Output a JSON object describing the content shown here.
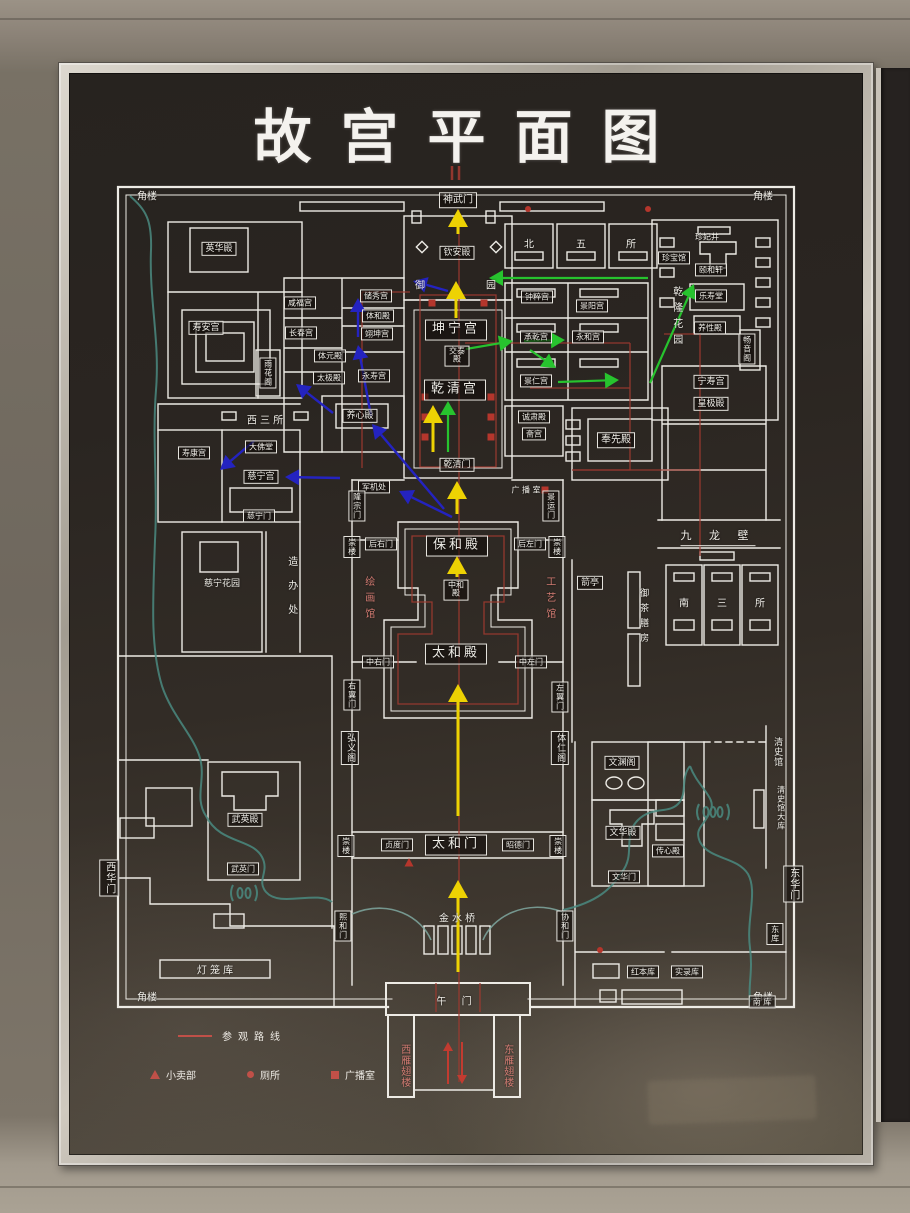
{
  "title": "故宫平面图",
  "legend": {
    "route_label": "参观路线",
    "kiosk_label": "小卖部",
    "toilet_label": "厕所",
    "broadcast_label": "广播室"
  },
  "map": {
    "colors": {
      "wall": "#edebe5",
      "river": "#4a8a80",
      "route": "#9e3a30",
      "marker": "#b5362c",
      "yellow": "#edd203",
      "green": "#27c32e",
      "blue": "#2423c0",
      "red": "#c23b30"
    },
    "labels": [
      {
        "name": "corner-tower-nw",
        "text": "角楼",
        "x": 147,
        "y": 197,
        "cls": "plain"
      },
      {
        "name": "corner-tower-ne",
        "text": "角楼",
        "x": 763,
        "y": 197,
        "cls": "plain"
      },
      {
        "name": "corner-tower-sw",
        "text": "角楼",
        "x": 147,
        "y": 998,
        "cls": "plain"
      },
      {
        "name": "corner-tower-se",
        "text": "角楼",
        "x": 763,
        "y": 998,
        "cls": "plain"
      },
      {
        "name": "label-shenwumen",
        "text": "神武门",
        "x": 458,
        "y": 200,
        "cls": "boxed"
      },
      {
        "name": "label-yinghuadian",
        "text": "英华殿",
        "x": 219,
        "y": 249,
        "cls": "boxed sm"
      },
      {
        "name": "label-shouangong",
        "text": "寿安宫",
        "x": 206,
        "y": 328,
        "cls": "boxed sm"
      },
      {
        "name": "label-yuhuage",
        "text": "雨花阁",
        "x": 268,
        "y": 373,
        "cls": "boxed v xs"
      },
      {
        "name": "label-xianfugong",
        "text": "咸福宫",
        "x": 300,
        "y": 303,
        "cls": "boxed xs"
      },
      {
        "name": "label-changchungong",
        "text": "长春宫",
        "x": 301,
        "y": 333,
        "cls": "boxed xs"
      },
      {
        "name": "label-tiyuandian",
        "text": "体元殿",
        "x": 330,
        "y": 356,
        "cls": "boxed xs"
      },
      {
        "name": "label-taijidian",
        "text": "太极殿",
        "x": 329,
        "y": 378,
        "cls": "boxed xs"
      },
      {
        "name": "label-chuxiugong",
        "text": "储秀宫",
        "x": 376,
        "y": 296,
        "cls": "boxed xs"
      },
      {
        "name": "label-tihedian",
        "text": "体和殿",
        "x": 378,
        "y": 316,
        "cls": "boxed xs"
      },
      {
        "name": "label-yikungong",
        "text": "翊坤宫",
        "x": 377,
        "y": 334,
        "cls": "boxed xs"
      },
      {
        "name": "label-yongshougong",
        "text": "永寿宫",
        "x": 374,
        "y": 376,
        "cls": "boxed xs"
      },
      {
        "name": "label-yangxindian",
        "text": "养心殿",
        "x": 360,
        "y": 416,
        "cls": "boxed sm"
      },
      {
        "name": "label-kunninggong",
        "text": "坤宁宫",
        "x": 456,
        "y": 330,
        "cls": "boxed big"
      },
      {
        "name": "label-jiaotaidian",
        "text": "交泰殿",
        "x": 457,
        "y": 356,
        "cls": "boxed xs narrow"
      },
      {
        "name": "label-qianqinggong",
        "text": "乾清宫",
        "x": 455,
        "y": 390,
        "cls": "boxed big"
      },
      {
        "name": "label-qianqingmen",
        "text": "乾清门",
        "x": 457,
        "y": 465,
        "cls": "boxed sm"
      },
      {
        "name": "label-junjichu",
        "text": "军机处",
        "x": 374,
        "y": 487,
        "cls": "boxed xs"
      },
      {
        "name": "label-longzongmen",
        "text": "隆宗门",
        "x": 357,
        "y": 506,
        "cls": "boxed v xs"
      },
      {
        "name": "label-jingyunmen",
        "text": "景运门",
        "x": 551,
        "y": 506,
        "cls": "boxed v xs"
      },
      {
        "name": "label-broadcast-room",
        "text": "广 播 室",
        "x": 526,
        "y": 490,
        "cls": "plain xs"
      },
      {
        "name": "label-qinandian",
        "text": "钦安殿",
        "x": 457,
        "y": 253,
        "cls": "boxed sm"
      },
      {
        "name": "label-yu",
        "text": "御",
        "x": 420,
        "y": 286,
        "cls": "plain"
      },
      {
        "name": "label-yuan",
        "text": "园",
        "x": 491,
        "y": 286,
        "cls": "plain"
      },
      {
        "name": "label-bei",
        "text": "北",
        "x": 529,
        "y": 245,
        "cls": "plain"
      },
      {
        "name": "label-wu",
        "text": "五",
        "x": 581,
        "y": 245,
        "cls": "plain"
      },
      {
        "name": "label-suo",
        "text": "所",
        "x": 631,
        "y": 245,
        "cls": "plain"
      },
      {
        "name": "label-zhongcuigong",
        "text": "钟粹宫",
        "x": 537,
        "y": 297,
        "cls": "boxed xs"
      },
      {
        "name": "label-jingyanggong",
        "text": "景阳宫",
        "x": 592,
        "y": 306,
        "cls": "boxed xs"
      },
      {
        "name": "label-chengqiangong",
        "text": "承乾宫",
        "x": 536,
        "y": 337,
        "cls": "boxed xs"
      },
      {
        "name": "label-yonghegong",
        "text": "永和宫",
        "x": 588,
        "y": 337,
        "cls": "boxed xs"
      },
      {
        "name": "label-jingrengong",
        "text": "景仁宫",
        "x": 536,
        "y": 381,
        "cls": "boxed xs"
      },
      {
        "name": "label-chengsudian",
        "text": "诚肃殿",
        "x": 534,
        "y": 417,
        "cls": "boxed xs"
      },
      {
        "name": "label-zhaigong",
        "text": "斋宫",
        "x": 534,
        "y": 434,
        "cls": "boxed xs"
      },
      {
        "name": "label-fengxiandian",
        "text": "奉先殿",
        "x": 616,
        "y": 440,
        "cls": "boxed"
      },
      {
        "name": "label-zhenfeijing",
        "text": "珍妃井",
        "x": 707,
        "y": 237,
        "cls": "plain xs"
      },
      {
        "name": "label-zhenbaoguan",
        "text": "珍宝馆",
        "x": 674,
        "y": 258,
        "cls": "boxed xs"
      },
      {
        "name": "label-yihexuan",
        "text": "颐和轩",
        "x": 711,
        "y": 270,
        "cls": "boxed xs"
      },
      {
        "name": "label-leshoutang",
        "text": "乐寿堂",
        "x": 711,
        "y": 296,
        "cls": "boxed xs"
      },
      {
        "name": "label-yangxingdian",
        "text": "养性殿",
        "x": 710,
        "y": 328,
        "cls": "boxed xs"
      },
      {
        "name": "label-changyinge",
        "text": "畅音阁",
        "x": 747,
        "y": 349,
        "cls": "boxed v xs"
      },
      {
        "name": "label-qianlong-garden",
        "text": "乾隆花园",
        "x": 676,
        "y": 318,
        "cls": "plain v sp1"
      },
      {
        "name": "label-ningshougong",
        "text": "宁寿宫",
        "x": 711,
        "y": 382,
        "cls": "boxed sm"
      },
      {
        "name": "label-huangjidian",
        "text": "皇极殿",
        "x": 711,
        "y": 404,
        "cls": "boxed sm"
      },
      {
        "name": "label-jiulongbi",
        "text": "九 龙 壁",
        "x": 718,
        "y": 538,
        "cls": "plain und"
      },
      {
        "name": "label-jianting",
        "text": "箭亭",
        "x": 590,
        "y": 583,
        "cls": "boxed sm"
      },
      {
        "name": "label-yuchashanfang",
        "text": "御茶膳房",
        "x": 643,
        "y": 618,
        "cls": "plain v sm sp1"
      },
      {
        "name": "label-nan",
        "text": "南",
        "x": 684,
        "y": 604,
        "cls": "plain"
      },
      {
        "name": "label-san",
        "text": "三",
        "x": 722,
        "y": 604,
        "cls": "plain"
      },
      {
        "name": "label-suo-2",
        "text": "所",
        "x": 760,
        "y": 604,
        "cls": "plain"
      },
      {
        "name": "label-baohedian",
        "text": "保和殿",
        "x": 457,
        "y": 546,
        "cls": "boxed big"
      },
      {
        "name": "label-houyoumen",
        "text": "后右门",
        "x": 381,
        "y": 544,
        "cls": "boxed xs"
      },
      {
        "name": "label-houzuomen",
        "text": "后左门",
        "x": 530,
        "y": 544,
        "cls": "boxed xs"
      },
      {
        "name": "label-chonglou-nw",
        "text": "崇楼",
        "x": 352,
        "y": 547,
        "cls": "boxed v xs"
      },
      {
        "name": "label-chonglou-ne",
        "text": "崇楼",
        "x": 557,
        "y": 547,
        "cls": "boxed v xs"
      },
      {
        "name": "label-chonglou-sw",
        "text": "崇楼",
        "x": 346,
        "y": 846,
        "cls": "boxed v xs"
      },
      {
        "name": "label-chonglou-se",
        "text": "崇楼",
        "x": 558,
        "y": 846,
        "cls": "boxed v xs"
      },
      {
        "name": "label-zhonghedian",
        "text": "中和殿",
        "x": 456,
        "y": 590,
        "cls": "boxed xs narrow"
      },
      {
        "name": "label-taihedian",
        "text": "太和殿",
        "x": 456,
        "y": 654,
        "cls": "boxed big"
      },
      {
        "name": "label-zhongyoumen",
        "text": "中右门",
        "x": 378,
        "y": 662,
        "cls": "boxed xs"
      },
      {
        "name": "label-zhongzuomen",
        "text": "中左门",
        "x": 531,
        "y": 662,
        "cls": "boxed xs"
      },
      {
        "name": "label-youyimen",
        "text": "右翼门",
        "x": 352,
        "y": 695,
        "cls": "boxed v xs"
      },
      {
        "name": "label-zuoyimen",
        "text": "左翼门",
        "x": 560,
        "y": 697,
        "cls": "boxed v xs"
      },
      {
        "name": "label-hongyige",
        "text": "弘义阁",
        "x": 350,
        "y": 748,
        "cls": "boxed v sm"
      },
      {
        "name": "label-tirenge",
        "text": "体仁阁",
        "x": 560,
        "y": 748,
        "cls": "boxed v sm"
      },
      {
        "name": "label-painting-gallery",
        "text": "绘画馆",
        "x": 368,
        "y": 600,
        "cls": "red v sp1"
      },
      {
        "name": "label-craft-gallery",
        "text": "工艺馆",
        "x": 549,
        "y": 600,
        "cls": "red v sp1"
      },
      {
        "name": "label-taihemen",
        "text": "太和门",
        "x": 456,
        "y": 845,
        "cls": "boxed big"
      },
      {
        "name": "label-zhendumen",
        "text": "贞度门",
        "x": 397,
        "y": 845,
        "cls": "boxed xs"
      },
      {
        "name": "label-zhaodemen",
        "text": "昭德门",
        "x": 518,
        "y": 845,
        "cls": "boxed xs"
      },
      {
        "name": "label-xihemen-gate",
        "text": "熙和门",
        "x": 343,
        "y": 926,
        "cls": "boxed v xs"
      },
      {
        "name": "label-xiehemen",
        "text": "协和门",
        "x": 565,
        "y": 926,
        "cls": "boxed v xs"
      },
      {
        "name": "label-jinshuiqiao",
        "text": "金 水 桥",
        "x": 457,
        "y": 919,
        "cls": "plain"
      },
      {
        "name": "label-wumen",
        "text": "午 门",
        "x": 457,
        "y": 1002,
        "cls": "plain sp1"
      },
      {
        "name": "label-west-wing",
        "text": "西雁翅楼",
        "x": 404,
        "y": 1066,
        "cls": "red v"
      },
      {
        "name": "label-east-wing",
        "text": "东雁翅楼",
        "x": 507,
        "y": 1066,
        "cls": "red v"
      },
      {
        "name": "label-dafotang",
        "text": "大佛堂",
        "x": 261,
        "y": 447,
        "cls": "boxed xs"
      },
      {
        "name": "label-cininggong",
        "text": "慈宁宫",
        "x": 261,
        "y": 477,
        "cls": "boxed sm"
      },
      {
        "name": "label-ciningmen",
        "text": "慈宁门",
        "x": 259,
        "y": 516,
        "cls": "boxed xs"
      },
      {
        "name": "label-shoukanggong",
        "text": "寿康宫",
        "x": 194,
        "y": 453,
        "cls": "boxed xs"
      },
      {
        "name": "label-xisansuo",
        "text": "西 三 所",
        "x": 265,
        "y": 421,
        "cls": "plain"
      },
      {
        "name": "label-cining-garden",
        "text": "慈宁花园",
        "x": 222,
        "y": 584,
        "cls": "plain sm"
      },
      {
        "name": "label-zaobanchu",
        "text": "造办处",
        "x": 291,
        "y": 592,
        "cls": "plain v sp2"
      },
      {
        "name": "label-wuyingdian",
        "text": "武英殿",
        "x": 245,
        "y": 820,
        "cls": "boxed sm"
      },
      {
        "name": "label-wuyingmen",
        "text": "武英门",
        "x": 243,
        "y": 869,
        "cls": "boxed xs"
      },
      {
        "name": "label-xihuamen",
        "text": "西华门",
        "x": 109,
        "y": 878,
        "cls": "boxed v"
      },
      {
        "name": "label-donghuamen",
        "text": "东华门",
        "x": 793,
        "y": 884,
        "cls": "boxed v"
      },
      {
        "name": "label-wenyuange",
        "text": "文渊阁",
        "x": 622,
        "y": 763,
        "cls": "boxed sm"
      },
      {
        "name": "label-wenhuadian",
        "text": "文华殿",
        "x": 623,
        "y": 833,
        "cls": "boxed sm"
      },
      {
        "name": "label-chuanxindian",
        "text": "传心殿",
        "x": 668,
        "y": 851,
        "cls": "boxed xs"
      },
      {
        "name": "label-wenhuamen",
        "text": "文华门",
        "x": 624,
        "y": 877,
        "cls": "boxed xs"
      },
      {
        "name": "label-qingshiguan",
        "text": "清史馆",
        "x": 777,
        "y": 752,
        "cls": "plain v sm"
      },
      {
        "name": "label-qingshiguan-daku",
        "text": "清史馆大库",
        "x": 781,
        "y": 808,
        "cls": "plain v xs"
      },
      {
        "name": "label-hongbenku",
        "text": "红本库",
        "x": 643,
        "y": 972,
        "cls": "boxed xs"
      },
      {
        "name": "label-shiluku",
        "text": "实录库",
        "x": 687,
        "y": 972,
        "cls": "boxed xs"
      },
      {
        "name": "label-nanku",
        "text": "南  库",
        "x": 762,
        "y": 1002,
        "cls": "boxed xs"
      },
      {
        "name": "label-dongku",
        "text": "东库",
        "x": 775,
        "y": 934,
        "cls": "boxed v xs"
      },
      {
        "name": "label-denglongku",
        "text": "灯 笼 库",
        "x": 215,
        "y": 971,
        "cls": "plain"
      }
    ],
    "arrows": [
      {
        "color": "yellow",
        "x1": 458,
        "y1": 972,
        "x2": 458,
        "y2": 880
      },
      {
        "color": "yellow",
        "x1": 458,
        "y1": 816,
        "x2": 458,
        "y2": 684
      },
      {
        "color": "yellow",
        "x1": 457,
        "y1": 577,
        "x2": 457,
        "y2": 556
      },
      {
        "color": "yellow",
        "x1": 457,
        "y1": 514,
        "x2": 457,
        "y2": 481
      },
      {
        "color": "yellow",
        "x1": 433,
        "y1": 452,
        "x2": 433,
        "y2": 405
      },
      {
        "color": "yellow",
        "x1": 456,
        "y1": 318,
        "x2": 456,
        "y2": 281
      },
      {
        "color": "yellow",
        "x1": 458,
        "y1": 234,
        "x2": 458,
        "y2": 209
      },
      {
        "color": "green",
        "x1": 448,
        "y1": 452,
        "x2": 448,
        "y2": 401
      },
      {
        "color": "green",
        "x1": 466,
        "y1": 349,
        "x2": 513,
        "y2": 341
      },
      {
        "color": "green",
        "x1": 524,
        "y1": 341,
        "x2": 565,
        "y2": 340
      },
      {
        "color": "green",
        "x1": 530,
        "y1": 350,
        "x2": 556,
        "y2": 368
      },
      {
        "color": "green",
        "x1": 558,
        "y1": 382,
        "x2": 619,
        "y2": 380
      },
      {
        "color": "green",
        "x1": 650,
        "y1": 383,
        "x2": 694,
        "y2": 284
      },
      {
        "color": "green",
        "x1": 648,
        "y1": 278,
        "x2": 489,
        "y2": 278
      },
      {
        "color": "blue",
        "x1": 452,
        "y1": 517,
        "x2": 399,
        "y2": 491
      },
      {
        "color": "blue",
        "x1": 444,
        "y1": 509,
        "x2": 372,
        "y2": 424
      },
      {
        "color": "blue",
        "x1": 371,
        "y1": 416,
        "x2": 358,
        "y2": 345
      },
      {
        "color": "blue",
        "x1": 358,
        "y1": 337,
        "x2": 358,
        "y2": 298
      },
      {
        "color": "blue",
        "x1": 333,
        "y1": 413,
        "x2": 296,
        "y2": 384
      },
      {
        "color": "blue",
        "x1": 448,
        "y1": 291,
        "x2": 413,
        "y2": 281
      },
      {
        "color": "blue",
        "x1": 340,
        "y1": 478,
        "x2": 285,
        "y2": 477
      },
      {
        "color": "blue",
        "x1": 254,
        "y1": 441,
        "x2": 220,
        "y2": 470
      },
      {
        "color": "red",
        "x1": 448,
        "y1": 1084,
        "x2": 448,
        "y2": 1042
      },
      {
        "color": "red",
        "x1": 462,
        "y1": 1042,
        "x2": 462,
        "y2": 1084
      }
    ],
    "symbols": [
      {
        "type": "square",
        "x": 425,
        "y": 397
      },
      {
        "type": "square",
        "x": 425,
        "y": 417
      },
      {
        "type": "square",
        "x": 425,
        "y": 437
      },
      {
        "type": "square",
        "x": 491,
        "y": 397
      },
      {
        "type": "square",
        "x": 491,
        "y": 417
      },
      {
        "type": "square",
        "x": 491,
        "y": 437
      },
      {
        "type": "square",
        "x": 432,
        "y": 303
      },
      {
        "type": "square",
        "x": 484,
        "y": 303
      },
      {
        "type": "square",
        "x": 545,
        "y": 490
      },
      {
        "type": "dot",
        "x": 600,
        "y": 950
      },
      {
        "type": "dot",
        "x": 528,
        "y": 209
      },
      {
        "type": "dot",
        "x": 648,
        "y": 209
      },
      {
        "type": "triangle",
        "x": 409,
        "y": 863
      }
    ]
  }
}
